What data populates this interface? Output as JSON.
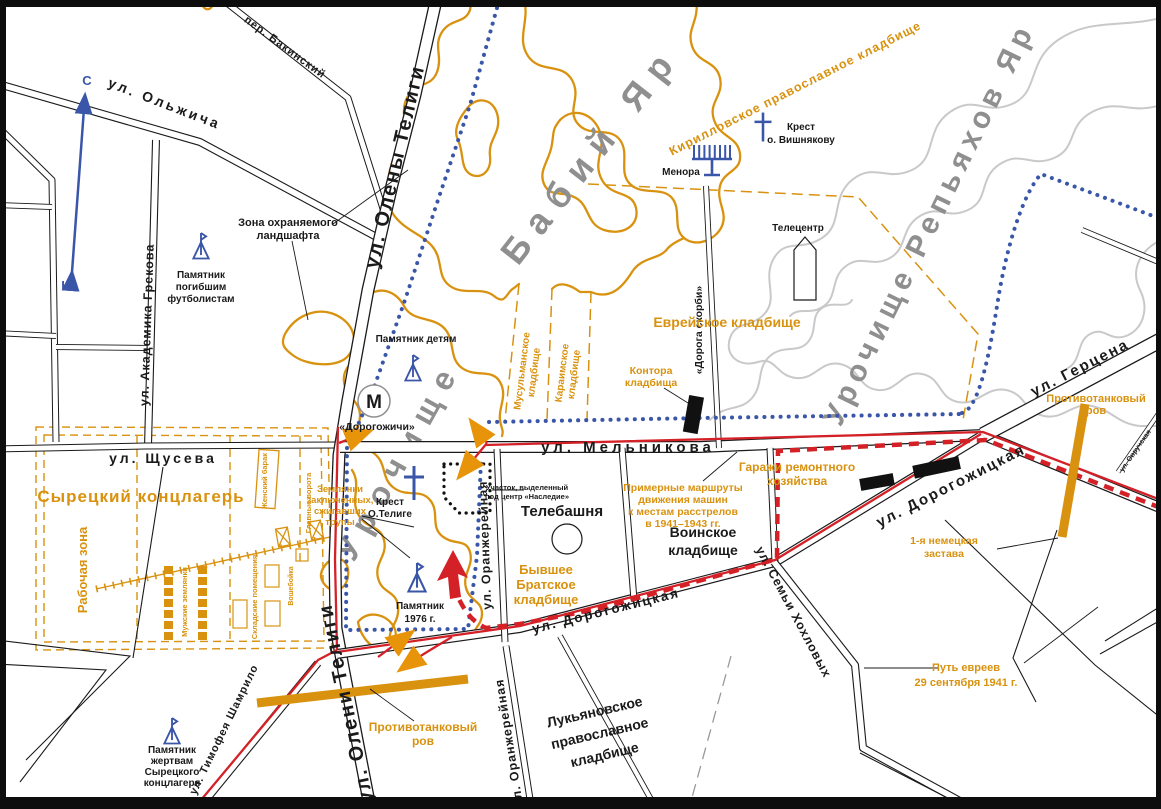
{
  "colors": {
    "orange": "#D9920F",
    "blue": "#3A56A8",
    "red": "#D42127",
    "gray_text": "#8F8F8F",
    "gray_contour": "#C9C9C9",
    "black": "#1a1a1a"
  },
  "compass": {
    "north": "С",
    "south": "Ю"
  },
  "streets": {
    "olzhycha": "ул. Ольжича",
    "bakinskiy": "пер. Бакинский",
    "teligi_top": "ул. Олены Телиги",
    "teligi_bottom": "ул. Олени Телиги",
    "grekova": "ул. Академика Грекова",
    "schuseva": "ул. Щусева",
    "melnikova": "ул. Мельникова",
    "oranzh_north": "ул. Оранжерейная",
    "oranzh_south": "ул. Оранжерейная",
    "dorogozhytska_sw": "ул. Дорогожицкая",
    "dorogozhytska_ne": "ул. Дорогожицкая",
    "gertsena": "ул. Герцена",
    "hohlovyh": "ул. Семьи Хохловых",
    "shamrylo": "ул. Тимофея Шамрило",
    "ovruchska": "ул. Овручская",
    "doroga_skorbi": "«Дорога скорби»"
  },
  "toponyms": {
    "babi_yar": "Бабий Яр",
    "urochysche": "Урочище",
    "repyahov_yar": "Урочище Репьяхов Яр"
  },
  "cemeteries": {
    "kirillovskoe": "Кирилловское православное кладбище",
    "evreiskoe": "Еврейское кладбище",
    "musulmanskoe": [
      "Мусульманское",
      "кладбище"
    ],
    "karaimskoe": [
      "Караимское",
      "кладбище"
    ],
    "bratskoe": [
      "Бывшее",
      "Братское",
      "кладбище"
    ],
    "voinskoe": [
      "Воинское",
      "кладбище"
    ],
    "lukyanovskoe": [
      "Лукьяновское",
      "православное",
      "кладбище"
    ]
  },
  "camp": {
    "title": "Сырецкий концлагерь",
    "rabochaya_zona": "Рабочая зона",
    "muzhskie_zemlyanki": "Мужские землянки",
    "skladskie": "Складские помещения",
    "voshebojka": "Вошебойка",
    "zhenskiy_barak": "Женский барак",
    "glavnye_vorota": "Главные ворота"
  },
  "monuments": {
    "futbolistam": [
      "Памятник",
      "погибшим",
      "футболистам"
    ],
    "detyam": "Памятник детям",
    "m1976": [
      "Памятник",
      "1976 г."
    ],
    "zhertvam": [
      "Памятник",
      "жертвам",
      "Сырецкого",
      "концлагеря"
    ],
    "krest_telige": [
      "Крест",
      "О.Телиге"
    ],
    "krest_vishnyakovu": [
      "Крест",
      "о. Вишнякову"
    ],
    "menora": "Менора"
  },
  "objects": {
    "metro_letter": "М",
    "metro_station": "«Дорогожичи»",
    "telecentr": "Телецентр",
    "telebashnya": "Телебашня",
    "kontora": [
      "Контора",
      "кладбища"
    ],
    "uchastok": [
      "Участок, выделенный",
      "под центр «Наследие»"
    ],
    "zona_landshafta": [
      "Зона охраняемого",
      "ландшафта"
    ],
    "garazhi": [
      "Гаражи ремонтного",
      "хозяйства"
    ]
  },
  "war_history": {
    "marshruty": [
      "Примерные маршруты",
      "движения машин",
      "к местам расстрелов",
      "в 1941–1943 гг."
    ],
    "zemlyanki": [
      "Землянки",
      "заключенных,",
      "сжигавших",
      "трупы"
    ],
    "protivotank_left": [
      "Противотанковый",
      "ров"
    ],
    "protivotank_right": [
      "Противотанковый",
      "ров"
    ],
    "zastava": [
      "1-я немецкая",
      "застава"
    ],
    "put_evreev": [
      "Путь евреев",
      "29 сентября 1941 г."
    ]
  }
}
